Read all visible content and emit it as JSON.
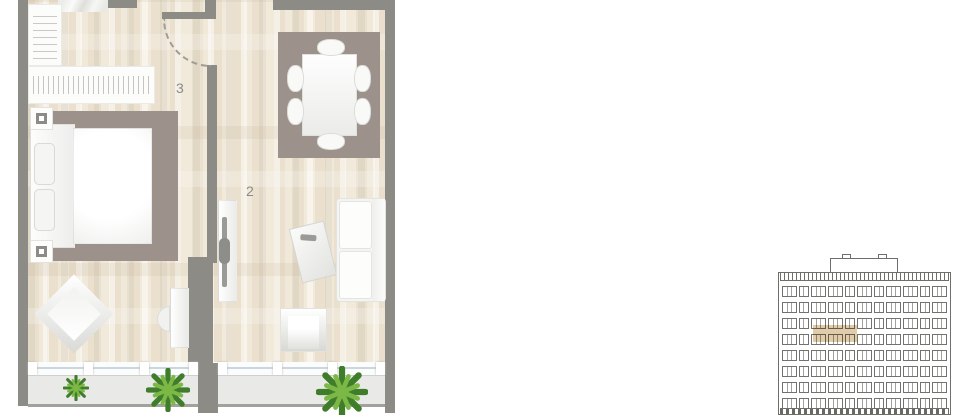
{
  "floor_plan": {
    "rooms": [
      {
        "label": "3",
        "name": "hallway"
      },
      {
        "label": "2",
        "name": "living-room"
      }
    ],
    "balcony_plants": 3
  },
  "building": {
    "floors_visible": 8,
    "windows_per_floor": 11,
    "pane_pattern": [
      3,
      2,
      3,
      3,
      2,
      3,
      2,
      3,
      3,
      2,
      3
    ],
    "highlighted_unit": {
      "floor_from_top": 4
    }
  },
  "colors": {
    "wall": "#8d8b85",
    "floor_a": "#eae0cd",
    "floor_b": "#f0e8d9",
    "rug": "#9c928b",
    "balcony": "#e9e9e7",
    "railing": "#a2a29c",
    "line": "#6f6f6a",
    "highlight": "#c7a163",
    "label": "#8b8b88",
    "plant_dark": "#3f7d2a",
    "plant_light": "#7cb845"
  }
}
